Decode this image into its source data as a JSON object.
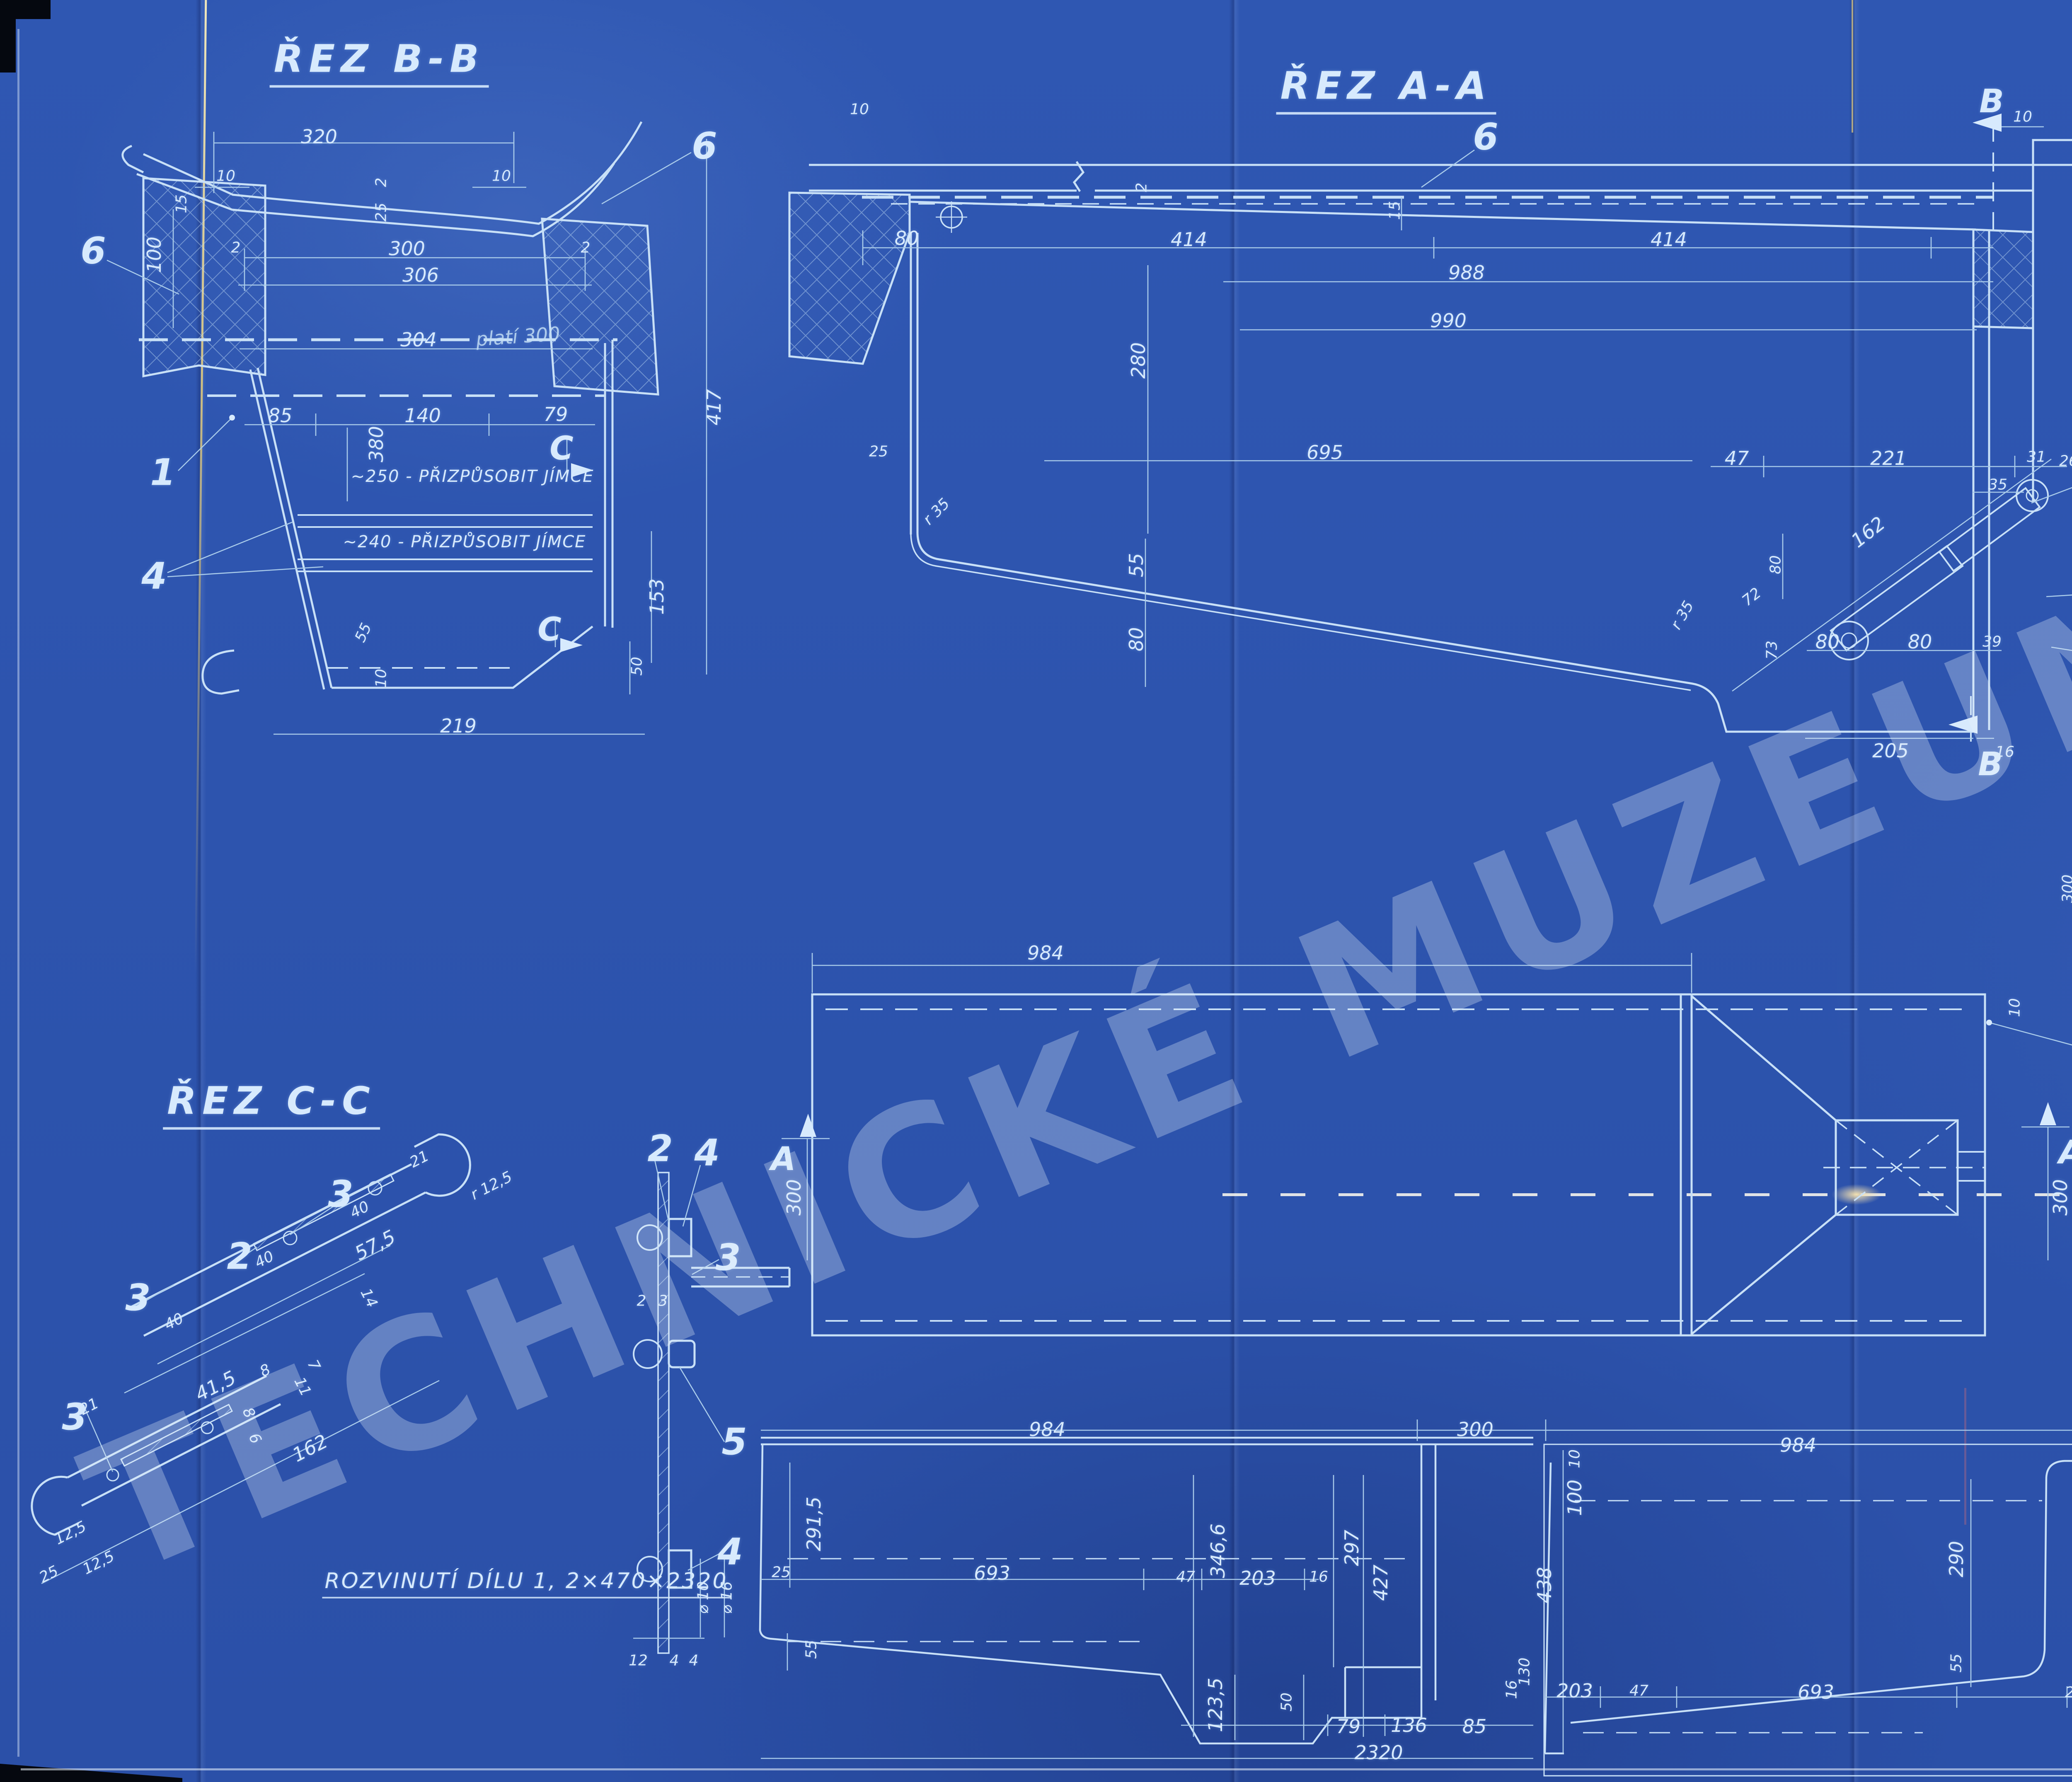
{
  "watermark": {
    "text": "TECHNICKÉ MUZEUM V BRNĚ"
  },
  "sections": {
    "rez_bb": "ŘEZ B-B",
    "rez_aa": "ŘEZ A-A",
    "rez_cc": "ŘEZ C-C",
    "rozvinuti_300": "ROZVINUTÍ DÍLU 1, 2×300×1070",
    "rozvinuti_470": "ROZVINUTÍ DÍLU 1, 2×470×2320"
  },
  "parts_table": {
    "rows": [
      {
        "pos": "7",
        "name": "SVAR",
        "icon": "",
        "qty": "1",
        "material": "ELEKTR",
        "dim": "△ 2 — 2,2 m",
        "weight": "",
        "note": ""
      },
      {
        "pos": "6",
        "name": "ŠROUB DO DŘEVA",
        "icon": "wood-screw-icon",
        "qty": "6.",
        "material": "St 38.13",
        "dim": "5×30  ČSN 1294/I.",
        "weight": "",
        "note": ""
      },
      {
        "pos": "5",
        "name": "NÝT",
        "icon": "rivet-icon",
        "qty": "8",
        "material": "St 34.13",
        "dim": "4.12  ČSN 1101/II",
        "weight": "",
        "note": ""
      },
      {
        "pos": "4",
        "name": "ZÁVĚSNÝ ČEP",
        "icon": "",
        "qty": "4",
        "material": "St 37.12",
        "dim": "⌀ 16 . 25",
        "weight": "0,04",
        "note": ""
      },
      {
        "pos": "3",
        "name": "ROŠTNICE",
        "icon": "",
        "qty": "2",
        "material": "St V.23",
        "dim": "2.58.270",
        "weight": "0,25",
        "note": ""
      },
      {
        "pos": "2",
        "name": "POSTRANICE ROŠTU",
        "icon": "",
        "qty": "1 LEVÁ\n1 PR.",
        "material": "St 37.12",
        "dim": "▭ 25.3 , 187",
        "weight": "0,11",
        "note": ""
      },
      {
        "pos": "1",
        "name": "JÍMKA NA PÍSEK LEVÁ",
        "icon": "",
        "qty": "1",
        "material": "St V.23",
        "dim": "2.470×2320\n2.300×1070",
        "weight": "4,82\n77,3",
        "note": "EL.SVAŘ"
      }
    ]
  },
  "ref_block": {
    "code": "0012",
    "year": "1941",
    "project": "2-NÁPR. MOTOR. VŮZ, JEDNOSMĚRNÝ.",
    "series": "3069-3098"
  },
  "title_block": {
    "vehicle_line1": "2-NÁPR. MOTOROVÝ VŮZ",
    "vehicle_line2": "JEDNOSMĚRNÝ.",
    "part_line1": "JÍMKA",
    "part_line2": "LEVÉHO PÍSKOVAČE.",
    "scale1": "2:5",
    "scale2": "1:1",
    "date": "23.6.1947",
    "class_num": "t",
    "class_den": "XIX",
    "drawing_number": "87800",
    "signature": "Poláček",
    "stamp": "PEP"
  },
  "hand_marks": {
    "red_number": "163",
    "red_note": "14.90 - M"
  },
  "colors": {
    "paper": "#2d54ae",
    "line": "#c8e0f7",
    "dim": "#a9cbea",
    "text": "#d7eafd",
    "red": "#8e2130"
  },
  "annotations": [
    {
      "t": "ŘEZ B-B",
      "x": 915,
      "y": 150,
      "r": 0,
      "c": "t-title"
    },
    {
      "t": "320",
      "x": 770,
      "y": 330,
      "r": 0,
      "c": "t-dim"
    },
    {
      "t": "10",
      "x": 545,
      "y": 425,
      "r": 0,
      "c": "t-dim-s"
    },
    {
      "t": "10",
      "x": 1210,
      "y": 425,
      "r": 0,
      "c": "t-dim-s"
    },
    {
      "t": "6",
      "x": 1700,
      "y": 352,
      "r": 0,
      "c": "t-callout"
    },
    {
      "t": "6",
      "x": 225,
      "y": 605,
      "r": 0,
      "c": "t-callout"
    },
    {
      "t": "15",
      "x": 438,
      "y": 492,
      "r": -90,
      "c": "t-dim-s"
    },
    {
      "t": "2",
      "x": 920,
      "y": 440,
      "r": -90,
      "c": "t-dim-s"
    },
    {
      "t": "25",
      "x": 920,
      "y": 512,
      "r": -90,
      "c": "t-dim-s"
    },
    {
      "t": "100",
      "x": 372,
      "y": 615,
      "r": -90,
      "c": "t-dim"
    },
    {
      "t": "2",
      "x": 569,
      "y": 598,
      "r": 0,
      "c": "t-dim-s"
    },
    {
      "t": "300",
      "x": 982,
      "y": 600,
      "r": 0,
      "c": "t-dim"
    },
    {
      "t": "2",
      "x": 1413,
      "y": 598,
      "r": 0,
      "c": "t-dim-s"
    },
    {
      "t": "306",
      "x": 1015,
      "y": 664,
      "r": 0,
      "c": "t-dim"
    },
    {
      "t": "304",
      "x": 1010,
      "y": 820,
      "r": 0,
      "c": "t-dim"
    },
    {
      "t": "platí 300",
      "x": 1250,
      "y": 812,
      "r": -4,
      "c": "t-hand"
    },
    {
      "t": "85",
      "x": 676,
      "y": 1003,
      "r": 0,
      "c": "t-dim"
    },
    {
      "t": "140",
      "x": 1020,
      "y": 1003,
      "r": 0,
      "c": "t-dim"
    },
    {
      "t": "79",
      "x": 1341,
      "y": 1000,
      "r": 0,
      "c": "t-dim"
    },
    {
      "t": "380",
      "x": 908,
      "y": 1072,
      "r": -90,
      "c": "t-dim"
    },
    {
      "t": "417",
      "x": 1723,
      "y": 983,
      "r": -90,
      "c": "t-dim"
    },
    {
      "t": "C",
      "x": 1355,
      "y": 1083,
      "r": 0,
      "c": "t-letter"
    },
    {
      "t": "C",
      "x": 1326,
      "y": 1520,
      "r": 0,
      "c": "t-letter"
    },
    {
      "t": "~250 - PŘIZPŮSOBIT JÍMCE",
      "x": 1140,
      "y": 1150,
      "r": 0,
      "c": "t-note"
    },
    {
      "t": "~240 - PŘIZPŮSOBIT JÍMCE",
      "x": 1121,
      "y": 1308,
      "r": 0,
      "c": "t-note"
    },
    {
      "t": "1",
      "x": 393,
      "y": 1140,
      "r": 0,
      "c": "t-callout"
    },
    {
      "t": "4",
      "x": 372,
      "y": 1390,
      "r": 0,
      "c": "t-callout"
    },
    {
      "t": "153",
      "x": 1585,
      "y": 1440,
      "r": -90,
      "c": "t-dim"
    },
    {
      "t": "50",
      "x": 1537,
      "y": 1608,
      "r": -90,
      "c": "t-dim-s"
    },
    {
      "t": "55",
      "x": 877,
      "y": 1527,
      "r": -65,
      "c": "t-dim-s"
    },
    {
      "t": "10",
      "x": 920,
      "y": 1637,
      "r": -90,
      "c": "t-dim-s"
    },
    {
      "t": "219",
      "x": 1106,
      "y": 1752,
      "r": 0,
      "c": "t-dim"
    },
    {
      "t": "ŘEZ A-A",
      "x": 3345,
      "y": 215,
      "r": 0,
      "c": "t-title"
    },
    {
      "t": "6",
      "x": 3585,
      "y": 330,
      "r": 0,
      "c": "t-callout"
    },
    {
      "t": "10",
      "x": 2074,
      "y": 264,
      "r": 0,
      "c": "t-dim-s"
    },
    {
      "t": "2",
      "x": 2755,
      "y": 452,
      "r": -90,
      "c": "t-dim-s"
    },
    {
      "t": "15",
      "x": 3366,
      "y": 508,
      "r": -90,
      "c": "t-dim-s"
    },
    {
      "t": "80",
      "x": 2188,
      "y": 575,
      "r": 0,
      "c": "t-dim"
    },
    {
      "t": "414",
      "x": 2869,
      "y": 578,
      "r": 0,
      "c": "t-dim"
    },
    {
      "t": "414",
      "x": 4027,
      "y": 578,
      "r": 0,
      "c": "t-dim"
    },
    {
      "t": "988",
      "x": 3539,
      "y": 658,
      "r": 0,
      "c": "t-dim"
    },
    {
      "t": "990",
      "x": 3495,
      "y": 774,
      "r": 0,
      "c": "t-dim"
    },
    {
      "t": "280",
      "x": 2747,
      "y": 870,
      "r": -90,
      "c": "t-dim"
    },
    {
      "t": "695",
      "x": 3197,
      "y": 1092,
      "r": 0,
      "c": "t-dim"
    },
    {
      "t": "25",
      "x": 2120,
      "y": 1090,
      "r": 0,
      "c": "t-dim-s"
    },
    {
      "t": "r 35",
      "x": 2260,
      "y": 1235,
      "r": -45,
      "c": "t-dim-s"
    },
    {
      "t": "55",
      "x": 2742,
      "y": 1364,
      "r": -90,
      "c": "t-dim"
    },
    {
      "t": "80",
      "x": 2742,
      "y": 1543,
      "r": -90,
      "c": "t-dim"
    },
    {
      "t": "r 35",
      "x": 4060,
      "y": 1485,
      "r": -60,
      "c": "t-dim-s"
    },
    {
      "t": "47",
      "x": 4191,
      "y": 1106,
      "r": 0,
      "c": "t-dim"
    },
    {
      "t": "221",
      "x": 4557,
      "y": 1106,
      "r": 0,
      "c": "t-dim"
    },
    {
      "t": "31",
      "x": 4914,
      "y": 1103,
      "r": 0,
      "c": "t-dim-s"
    },
    {
      "t": "26",
      "x": 4992,
      "y": 1113,
      "r": 0,
      "c": "t-dim-s"
    },
    {
      "t": "35",
      "x": 4821,
      "y": 1170,
      "r": 0,
      "c": "t-dim-s"
    },
    {
      "t": "162",
      "x": 4508,
      "y": 1284,
      "r": -38,
      "c": "t-dim"
    },
    {
      "t": "80",
      "x": 4285,
      "y": 1363,
      "r": -90,
      "c": "t-dim-s"
    },
    {
      "t": "72",
      "x": 4227,
      "y": 1441,
      "r": -38,
      "c": "t-dim-s"
    },
    {
      "t": "80",
      "x": 4410,
      "y": 1549,
      "r": 0,
      "c": "t-dim"
    },
    {
      "t": "80",
      "x": 4633,
      "y": 1549,
      "r": 0,
      "c": "t-dim"
    },
    {
      "t": "73",
      "x": 4276,
      "y": 1569,
      "r": -90,
      "c": "t-dim-s"
    },
    {
      "t": "39",
      "x": 4807,
      "y": 1549,
      "r": 0,
      "c": "t-dim-s"
    },
    {
      "t": "130",
      "x": 5111,
      "y": 1484,
      "r": -90,
      "c": "t-dim"
    },
    {
      "t": "205",
      "x": 4562,
      "y": 1812,
      "r": 0,
      "c": "t-dim"
    },
    {
      "t": "16",
      "x": 4838,
      "y": 1815,
      "r": 0,
      "c": "t-dim-s"
    },
    {
      "t": "287",
      "x": 5121,
      "y": 913,
      "r": -90,
      "c": "t-dim"
    },
    {
      "t": "10",
      "x": 4881,
      "y": 282,
      "r": 0,
      "c": "t-dim-s"
    },
    {
      "t": "B",
      "x": 4806,
      "y": 245,
      "r": 0,
      "c": "t-letter"
    },
    {
      "t": "B",
      "x": 4803,
      "y": 1845,
      "r": 0,
      "c": "t-letter"
    },
    {
      "t": "1",
      "x": 5298,
      "y": 1060,
      "r": 0,
      "c": "t-callout"
    },
    {
      "t": "3",
      "x": 5289,
      "y": 1413,
      "r": 0,
      "c": "t-callout"
    },
    {
      "t": "2",
      "x": 5316,
      "y": 1610,
      "r": 0,
      "c": "t-callout"
    },
    {
      "t": "984",
      "x": 2523,
      "y": 2300,
      "r": 0,
      "c": "t-dim"
    },
    {
      "t": "300",
      "x": 1916,
      "y": 2890,
      "r": -90,
      "c": "t-dim"
    },
    {
      "t": "300",
      "x": 4972,
      "y": 2890,
      "r": -90,
      "c": "t-dim"
    },
    {
      "t": "10",
      "x": 4862,
      "y": 2432,
      "r": -90,
      "c": "t-dim-s"
    },
    {
      "t": "1",
      "x": 5172,
      "y": 2543,
      "r": 0,
      "c": "t-callout"
    },
    {
      "t": "A",
      "x": 1890,
      "y": 2798,
      "r": 0,
      "c": "t-letter"
    },
    {
      "t": "A",
      "x": 4998,
      "y": 2782,
      "r": 0,
      "c": "t-letter"
    },
    {
      "t": "ROZVINUTÍ DÍLU 1, 2×300×1070",
      "x": 5762,
      "y": 1878,
      "r": 0,
      "c": "t-sub"
    },
    {
      "t": "300",
      "x": 4990,
      "y": 2145,
      "r": -90,
      "c": "t-dim-s"
    },
    {
      "t": "255",
      "x": 5354,
      "y": 2110,
      "r": -90,
      "c": "t-dim"
    },
    {
      "t": "245",
      "x": 6228,
      "y": 2118,
      "r": -90,
      "c": "t-dim"
    },
    {
      "t": "79",
      "x": 6630,
      "y": 2000,
      "r": -90,
      "c": "t-dim-s"
    },
    {
      "t": "136",
      "x": 6630,
      "y": 2133,
      "r": -90,
      "c": "t-dim"
    },
    {
      "t": "25",
      "x": 5448,
      "y": 2338,
      "r": 0,
      "c": "t-dim-s"
    },
    {
      "t": "25",
      "x": 5512,
      "y": 2338,
      "r": 0,
      "c": "t-dim-s"
    },
    {
      "t": "15",
      "x": 6398,
      "y": 2338,
      "r": 0,
      "c": "t-dim-s"
    },
    {
      "t": "15",
      "x": 6462,
      "y": 2338,
      "r": 0,
      "c": "t-dim-s"
    },
    {
      "t": "10",
      "x": 5043,
      "y": 2430,
      "r": 0,
      "c": "t-dim-s"
    },
    {
      "t": "100",
      "x": 5148,
      "y": 2430,
      "r": 0,
      "c": "t-dim"
    },
    {
      "t": "181",
      "x": 5354,
      "y": 2430,
      "r": 0,
      "c": "t-dim"
    },
    {
      "t": "685",
      "x": 6009,
      "y": 2430,
      "r": 0,
      "c": "t-dim"
    },
    {
      "t": "90",
      "x": 6520,
      "y": 2430,
      "r": 0,
      "c": "t-dim"
    },
    {
      "t": "4",
      "x": 6600,
      "y": 2428,
      "r": 0,
      "c": "t-dim-s"
    },
    {
      "t": "1070",
      "x": 5838,
      "y": 2492,
      "r": 0,
      "c": "t-dim"
    },
    {
      "t": "ŘEZ C-C",
      "x": 655,
      "y": 2665,
      "r": 0,
      "c": "t-title"
    },
    {
      "t": "2",
      "x": 1593,
      "y": 2772,
      "r": 0,
      "c": "t-callout"
    },
    {
      "t": "4",
      "x": 1706,
      "y": 2782,
      "r": 0,
      "c": "t-callout"
    },
    {
      "t": "3",
      "x": 822,
      "y": 2882,
      "r": 0,
      "c": "t-callout"
    },
    {
      "t": "2",
      "x": 578,
      "y": 3032,
      "r": 0,
      "c": "t-callout"
    },
    {
      "t": "3",
      "x": 333,
      "y": 3132,
      "r": 0,
      "c": "t-callout"
    },
    {
      "t": "3",
      "x": 180,
      "y": 3420,
      "r": 0,
      "c": "t-callout"
    },
    {
      "t": "3",
      "x": 1757,
      "y": 3035,
      "r": 0,
      "c": "t-callout"
    },
    {
      "t": "5",
      "x": 1772,
      "y": 3480,
      "r": 0,
      "c": "t-callout"
    },
    {
      "t": "4",
      "x": 1762,
      "y": 3745,
      "r": 0,
      "c": "t-callout"
    },
    {
      "t": "21",
      "x": 1012,
      "y": 2798,
      "r": -27,
      "c": "t-dim-s"
    },
    {
      "t": "r 12,5",
      "x": 1186,
      "y": 2862,
      "r": -27,
      "c": "t-dim-s"
    },
    {
      "t": "40",
      "x": 868,
      "y": 2920,
      "r": -27,
      "c": "t-dim-s"
    },
    {
      "t": "57,5",
      "x": 905,
      "y": 3005,
      "r": -27,
      "c": "t-dim"
    },
    {
      "t": "40",
      "x": 638,
      "y": 3040,
      "r": -27,
      "c": "t-dim-s"
    },
    {
      "t": "14",
      "x": 890,
      "y": 3133,
      "r": 63,
      "c": "t-dim-s"
    },
    {
      "t": "40",
      "x": 420,
      "y": 3190,
      "r": -27,
      "c": "t-dim-s"
    },
    {
      "t": "8",
      "x": 640,
      "y": 3308,
      "r": -27,
      "c": "t-dim-s"
    },
    {
      "t": "41,5",
      "x": 520,
      "y": 3345,
      "r": -27,
      "c": "t-dim"
    },
    {
      "t": "7",
      "x": 757,
      "y": 3295,
      "r": 63,
      "c": "t-dim-s"
    },
    {
      "t": "11",
      "x": 730,
      "y": 3347,
      "r": 63,
      "c": "t-dim-s"
    },
    {
      "t": "8",
      "x": 600,
      "y": 3410,
      "r": 63,
      "c": "t-dim-s"
    },
    {
      "t": "6",
      "x": 615,
      "y": 3472,
      "r": 63,
      "c": "t-dim-s"
    },
    {
      "t": "21",
      "x": 215,
      "y": 3395,
      "r": -27,
      "c": "t-dim-s"
    },
    {
      "t": "162",
      "x": 748,
      "y": 3495,
      "r": -27,
      "c": "t-dim"
    },
    {
      "t": "12,5",
      "x": 170,
      "y": 3700,
      "r": -27,
      "c": "t-dim-s"
    },
    {
      "t": "12,5",
      "x": 238,
      "y": 3772,
      "r": -27,
      "c": "t-dim-s"
    },
    {
      "t": "25",
      "x": 118,
      "y": 3800,
      "r": -27,
      "c": "t-dim-s"
    },
    {
      "t": "2",
      "x": 1548,
      "y": 3140,
      "r": 0,
      "c": "t-dim-s"
    },
    {
      "t": "3",
      "x": 1600,
      "y": 3140,
      "r": 0,
      "c": "t-dim-s"
    },
    {
      "t": "12",
      "x": 1540,
      "y": 4008,
      "r": 0,
      "c": "t-dim-s"
    },
    {
      "t": "4",
      "x": 1627,
      "y": 4008,
      "r": 0,
      "c": "t-dim-s"
    },
    {
      "t": "4",
      "x": 1674,
      "y": 4008,
      "r": 0,
      "c": "t-dim-s"
    },
    {
      "t": "⌀ 10",
      "x": 1697,
      "y": 3856,
      "r": -90,
      "c": "t-dim-s"
    },
    {
      "t": "⌀ 16",
      "x": 1754,
      "y": 3856,
      "r": -90,
      "c": "t-dim-s"
    },
    {
      "t": "ROZVINUTÍ DÍLU 1, 2×470×2320",
      "x": 1270,
      "y": 3822,
      "r": 0,
      "c": "t-sub"
    },
    {
      "t": "984",
      "x": 2527,
      "y": 3450,
      "r": 0,
      "c": "t-dim"
    },
    {
      "t": "300",
      "x": 3560,
      "y": 3450,
      "r": 0,
      "c": "t-dim"
    },
    {
      "t": "291,5",
      "x": 1964,
      "y": 3678,
      "r": -90,
      "c": "t-dim"
    },
    {
      "t": "25",
      "x": 1885,
      "y": 3795,
      "r": 0,
      "c": "t-dim-s"
    },
    {
      "t": "693",
      "x": 2394,
      "y": 3797,
      "r": 0,
      "c": "t-dim"
    },
    {
      "t": "47",
      "x": 2861,
      "y": 3806,
      "r": 0,
      "c": "t-dim-s"
    },
    {
      "t": "346,6",
      "x": 2939,
      "y": 3743,
      "r": -90,
      "c": "t-dim"
    },
    {
      "t": "203",
      "x": 3035,
      "y": 3809,
      "r": 0,
      "c": "t-dim"
    },
    {
      "t": "16",
      "x": 3182,
      "y": 3806,
      "r": 0,
      "c": "t-dim-s"
    },
    {
      "t": "297",
      "x": 3262,
      "y": 3736,
      "r": -90,
      "c": "t-dim"
    },
    {
      "t": "427",
      "x": 3332,
      "y": 3820,
      "r": -90,
      "c": "t-dim"
    },
    {
      "t": "55",
      "x": 1958,
      "y": 3981,
      "r": -90,
      "c": "t-dim-s"
    },
    {
      "t": "123,5",
      "x": 2933,
      "y": 4115,
      "r": -90,
      "c": "t-dim"
    },
    {
      "t": "50",
      "x": 3105,
      "y": 4108,
      "r": -90,
      "c": "t-dim-s"
    },
    {
      "t": "79",
      "x": 3254,
      "y": 4167,
      "r": 0,
      "c": "t-dim"
    },
    {
      "t": "136",
      "x": 3400,
      "y": 4164,
      "r": 0,
      "c": "t-dim"
    },
    {
      "t": "85",
      "x": 3558,
      "y": 4167,
      "r": 0,
      "c": "t-dim"
    },
    {
      "t": "2320",
      "x": 3327,
      "y": 4230,
      "r": 0,
      "c": "t-dim"
    },
    {
      "t": "984",
      "x": 4339,
      "y": 3488,
      "r": 0,
      "c": "t-dim"
    },
    {
      "t": "10",
      "x": 3800,
      "y": 3521,
      "r": -90,
      "c": "t-dim-s"
    },
    {
      "t": "100",
      "x": 3800,
      "y": 3615,
      "r": -90,
      "c": "t-dim"
    },
    {
      "t": "438",
      "x": 3727,
      "y": 3826,
      "r": -90,
      "c": "t-dim"
    },
    {
      "t": "130",
      "x": 3679,
      "y": 4035,
      "r": -90,
      "c": "t-dim-s"
    },
    {
      "t": "16",
      "x": 3648,
      "y": 4078,
      "r": -90,
      "c": "t-dim-s"
    },
    {
      "t": "203",
      "x": 3800,
      "y": 4081,
      "r": 0,
      "c": "t-dim"
    },
    {
      "t": "47",
      "x": 3955,
      "y": 4081,
      "r": 0,
      "c": "t-dim-s"
    },
    {
      "t": "693",
      "x": 4382,
      "y": 4084,
      "r": 0,
      "c": "t-dim"
    },
    {
      "t": "290",
      "x": 4721,
      "y": 3763,
      "r": -90,
      "c": "t-dim"
    },
    {
      "t": "55",
      "x": 4721,
      "y": 4014,
      "r": -90,
      "c": "t-dim-s"
    },
    {
      "t": "25",
      "x": 5006,
      "y": 4085,
      "r": 0,
      "c": "t-dim-s"
    },
    {
      "t": "470",
      "x": 5133,
      "y": 3866,
      "r": -90,
      "c": "t-dim"
    }
  ]
}
